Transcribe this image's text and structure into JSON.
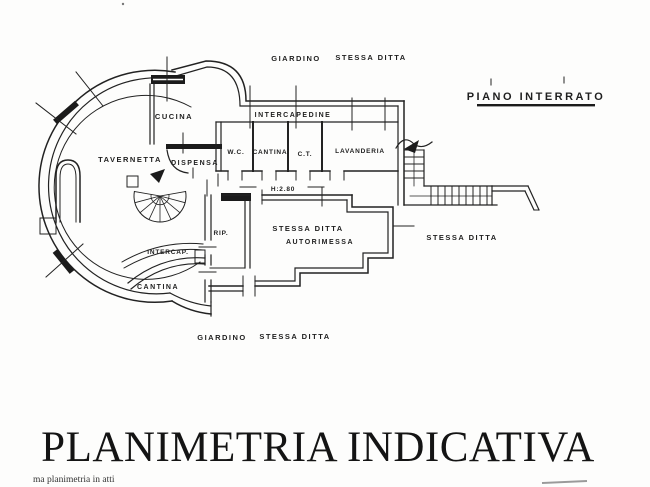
{
  "drawing": {
    "plan_title": "PIANO INTERRATO",
    "rooms": {
      "cucina": "CUCINA",
      "tavernetta": "TAVERNETTA",
      "dispensa": "DISPENSA",
      "wc": "W.C.",
      "cantina_upper": "CANTINA",
      "ct": "C.T.",
      "lavanderia": "LAVANDERIA",
      "rip": "RIP.",
      "autorimessa_owner": "STESSA DITTA",
      "autorimessa": "AUTORIMESSA",
      "intercap": "INTERCAP.",
      "cantina_lower": "CANTINA",
      "intercapedine": "INTERCAPEDINE"
    },
    "site_labels": {
      "giardino_top": "GIARDINO",
      "stessa_ditta_top": "STESSA DITTA",
      "stessa_ditta_right": "STESSA DITTA",
      "giardino_bottom": "GIARDINO",
      "stessa_ditta_bottom": "STESSA DITTA"
    },
    "dimensions": {
      "ceiling_height": "H:2.80"
    }
  },
  "footer": {
    "title": "PLANIMETRIA INDICATIVA",
    "note": "ma planimetria in atti"
  },
  "colors": {
    "ink": "#1f1f1f",
    "paper": "#fdfdfc",
    "artifact_gray": "#9a9a9a"
  }
}
